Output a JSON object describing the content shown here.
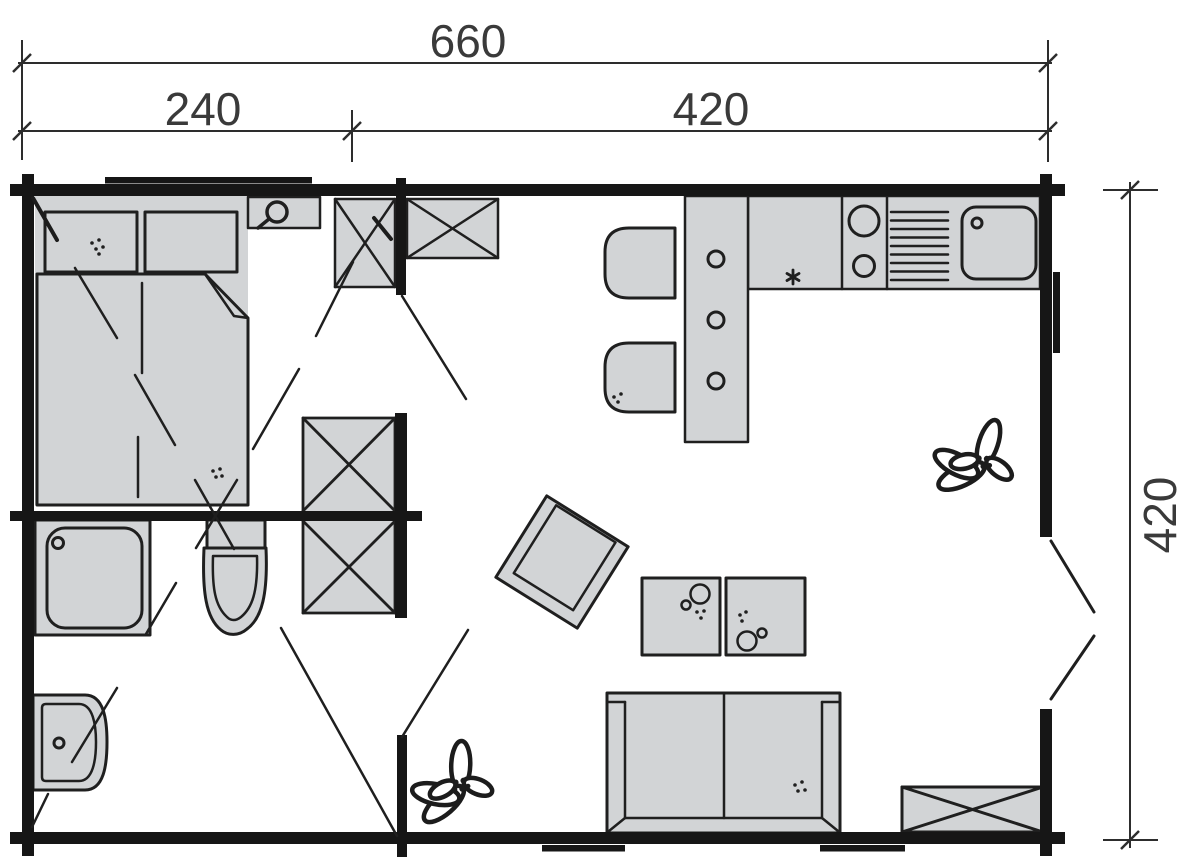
{
  "diagram": {
    "type": "floor-plan",
    "dimensions": {
      "overall_width": "660",
      "section_left": "240",
      "section_right": "420",
      "overall_depth": "420"
    },
    "colors": {
      "wall": "#161616",
      "line": "#1f1f1f",
      "furniture_fill": "#d2d4d6",
      "dimension_text": "#3a3a3a",
      "background": "#ffffff"
    },
    "fixtures": [
      "double-bed",
      "pillows",
      "blanket",
      "nightstand",
      "reading-lamp",
      "wardrobe-top-left",
      "wardrobe-top-right",
      "wardrobe-central",
      "shower",
      "toilet",
      "washbasin",
      "kitchen-counter",
      "stove-burners",
      "dish-drainer",
      "kitchen-sink",
      "dining-table",
      "chair",
      "chair",
      "armchair",
      "coffee-table",
      "coffee-table",
      "sofa",
      "storage-unit",
      "plant",
      "plant",
      "window",
      "window",
      "window",
      "door-swing"
    ]
  }
}
